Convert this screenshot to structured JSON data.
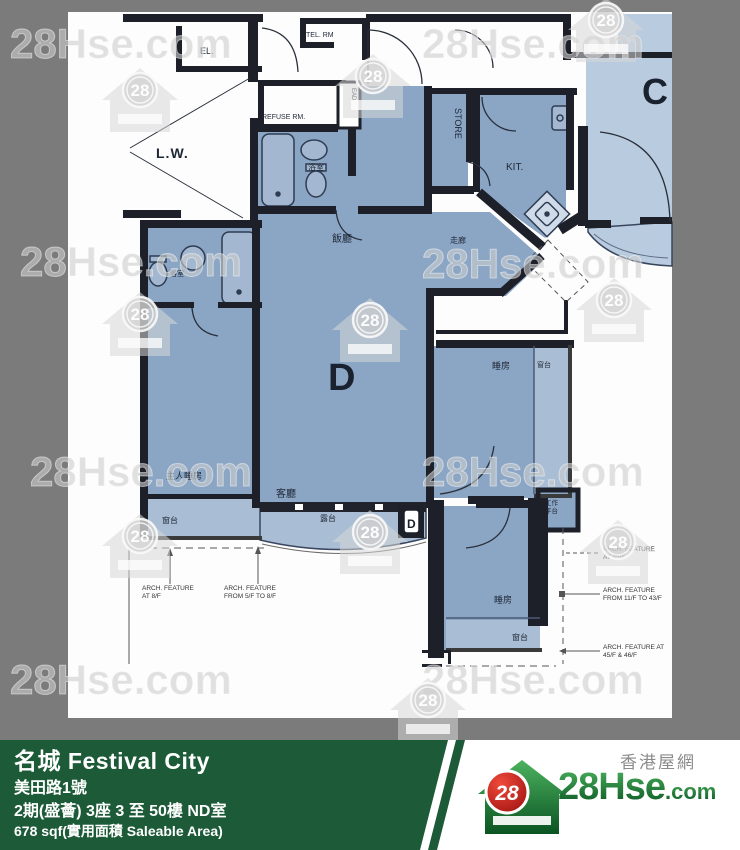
{
  "watermark": {
    "text": "28Hse.com",
    "badge": "28"
  },
  "plan": {
    "common": {
      "lw": "L.W.",
      "el": "EL.",
      "tel": "TEL. RM",
      "refuse": "REFUSE RM.",
      "ead": "EAD"
    },
    "unit_d_letter": "D",
    "unit_c_letter": "C",
    "door_marker": "D",
    "rooms": {
      "bath1": "浴室",
      "dining": "飯廳",
      "corridor": "走廊",
      "store": "STORE",
      "kitchen": "KIT.",
      "living": "客廳",
      "master": "主人睡房",
      "bath2": "浴室",
      "master_bay": "窗台",
      "balcony": "露台",
      "bed1": "睡房",
      "bed1_bay": "窗台",
      "util1": "工作",
      "util2": "平台",
      "bed2": "睡房",
      "bed2_bay": "窗台"
    },
    "annotations": {
      "l1a": "ARCH. FEATURE",
      "l1b": "AT 8/F",
      "l2a": "ARCH. FEATURE",
      "l2b": "FROM 5/F TO 8/F",
      "r1a": "ARCH. FEATURE",
      "r1b": "AT 45/F",
      "r2a": "ARCH. FEATURE",
      "r2b": "FROM 11/F TO 43/F",
      "r3a": "ARCH. FEATURE AT",
      "r3b": "45/F & 46/F"
    }
  },
  "footer": {
    "title": "名城 Festival City",
    "address": "美田路1號",
    "phase": "2期(盛薈) 3座 3 至 50樓 ND室",
    "area": "678 sqf(實用面積 Saleable Area)",
    "site_name": "香港屋網",
    "logo_main": "28Hse",
    "logo_suffix": ".com",
    "logo_badge": "28"
  },
  "colors": {
    "background_gray": "#7b7b7b",
    "unit_d_blue": "#8ba6c5",
    "unit_c_blue": "#b9cbdf",
    "bay_blue": "#a9bed4",
    "wall_black": "#1d1f29",
    "footer_green": "#1d5b38",
    "logo_red": "#c41818",
    "logo_green": "#1d7a34"
  }
}
